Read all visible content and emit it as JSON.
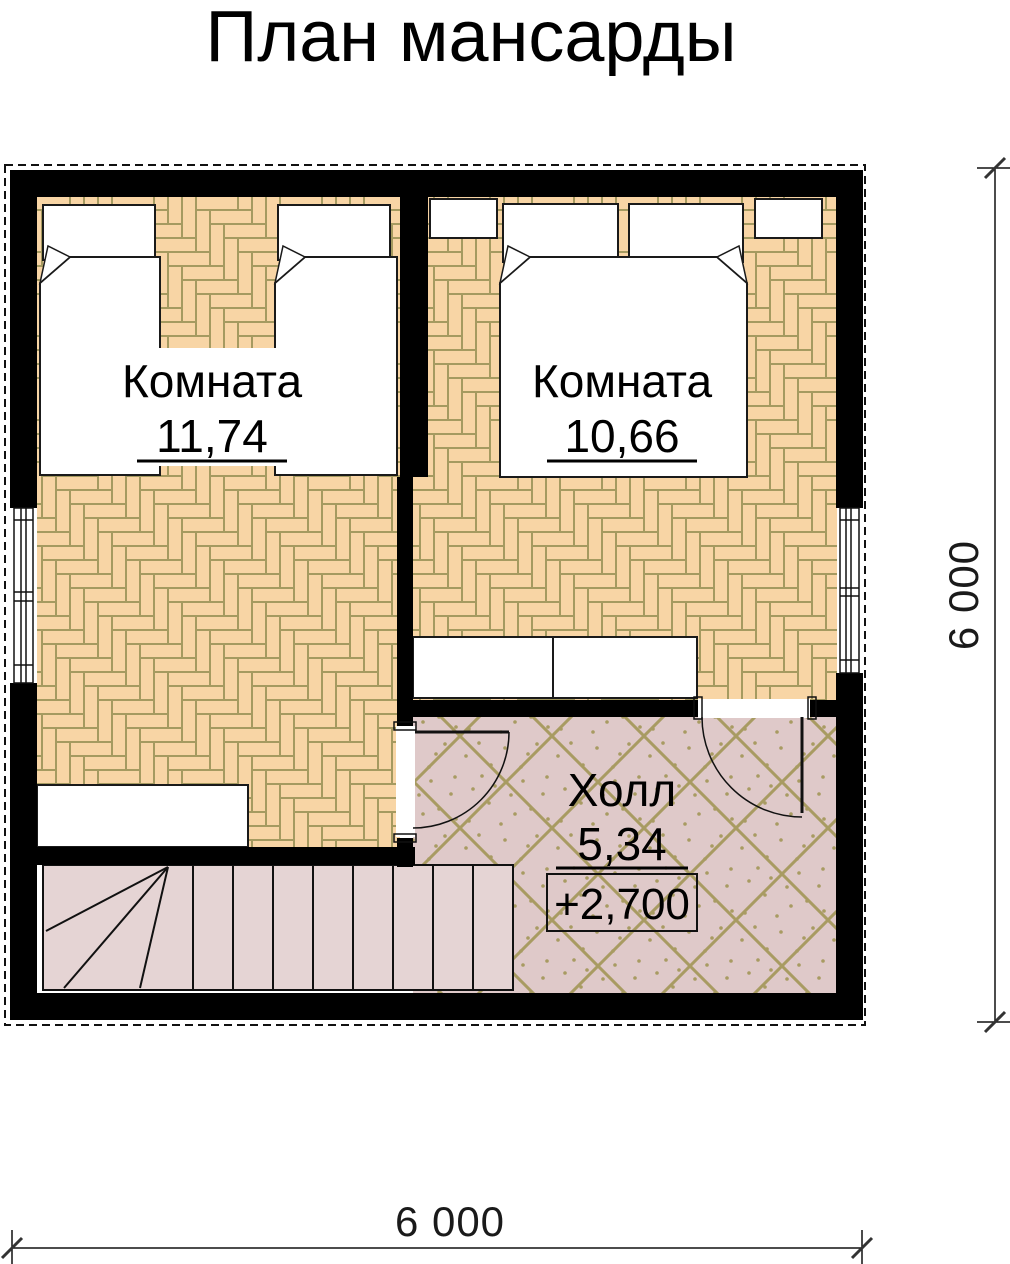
{
  "title": "План мансарды",
  "rooms": [
    {
      "name": "Комната",
      "area": "11,74"
    },
    {
      "name": "Комната",
      "area": "10,66"
    },
    {
      "name": "Холл",
      "area": "5,34",
      "elevation": "+2,700"
    }
  ],
  "dimensions": {
    "bottom": "6 000",
    "right": "6 000"
  },
  "colors": {
    "wall": "#000000",
    "line": "#111111",
    "parquet_fill": "#F8D5A5",
    "parquet_line": "#A59A60",
    "tile_fill": "#DFC9C9",
    "tile_line": "#A89B62",
    "stairs_fill": "#E5D4D4",
    "furniture_fill": "#FFFFFF"
  }
}
